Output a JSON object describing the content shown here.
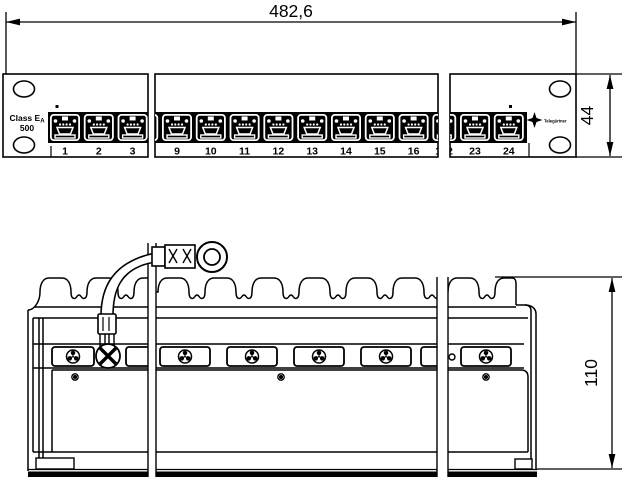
{
  "drawing": {
    "type": "patch-panel technical drawing, front and rear views"
  },
  "dimensions": {
    "width_label": "482,6",
    "front_height_label": "44",
    "rear_height_label": "110"
  },
  "front": {
    "class_label": {
      "main": "Class E",
      "sub": "A",
      "line2": "500"
    },
    "brand": "Telegärtner",
    "sections": [
      {
        "ports": [
          "1",
          "2",
          "3"
        ]
      },
      {
        "ports": [
          "9",
          "10",
          "11",
          "12",
          "13",
          "14",
          "15",
          "16",
          "17"
        ]
      },
      {
        "ports": [
          "22",
          "23",
          "24"
        ]
      }
    ]
  },
  "colors": {
    "ink": "#000000",
    "paper": "#ffffff"
  }
}
